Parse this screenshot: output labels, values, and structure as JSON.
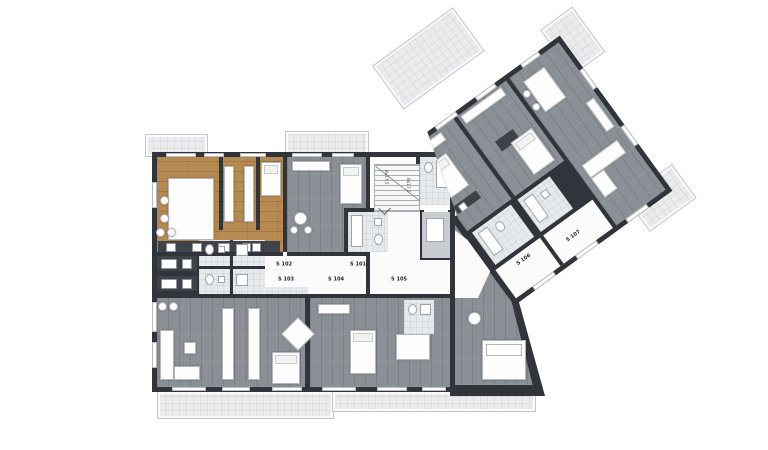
{
  "plan": {
    "units": [
      {
        "label": "S 101",
        "highlighted": false
      },
      {
        "label": "S 102",
        "highlighted": true
      },
      {
        "label": "S 103",
        "highlighted": false
      },
      {
        "label": "S 104",
        "highlighted": false
      },
      {
        "label": "S 105",
        "highlighted": false
      },
      {
        "label": "S 106",
        "highlighted": false
      },
      {
        "label": "S 107",
        "highlighted": false
      }
    ],
    "stairs": {
      "run_label": "8x17,5"
    },
    "colors": {
      "wall": "#31353b",
      "floor_gray": "#8a9096",
      "floor_highlight": "#b78a52",
      "balcony": "#e9ebec",
      "white_room": "#fbfbfc",
      "tile": "#e7eaec"
    }
  }
}
